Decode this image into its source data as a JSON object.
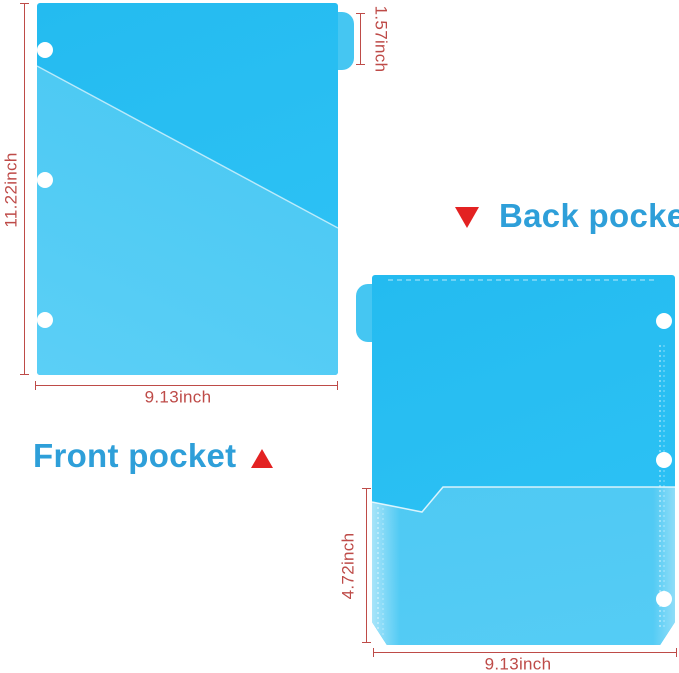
{
  "colors": {
    "folder_blue": "#24BBF0",
    "pocket_blue": "#4CC9F3",
    "tab_blue": "#45C6F2",
    "label_blue": "#2E9FD9",
    "dimension_red": "#BE4B48",
    "arrow_red": "#E32222"
  },
  "front_folder": {
    "name_label": "Front pocket",
    "height_dim": "11.22inch",
    "width_dim": "9.13inch",
    "tab_dim": "1.57inch"
  },
  "back_folder": {
    "name_label": "Back pocket",
    "pocket_height_dim": "4.72inch",
    "width_dim": "9.13inch"
  }
}
